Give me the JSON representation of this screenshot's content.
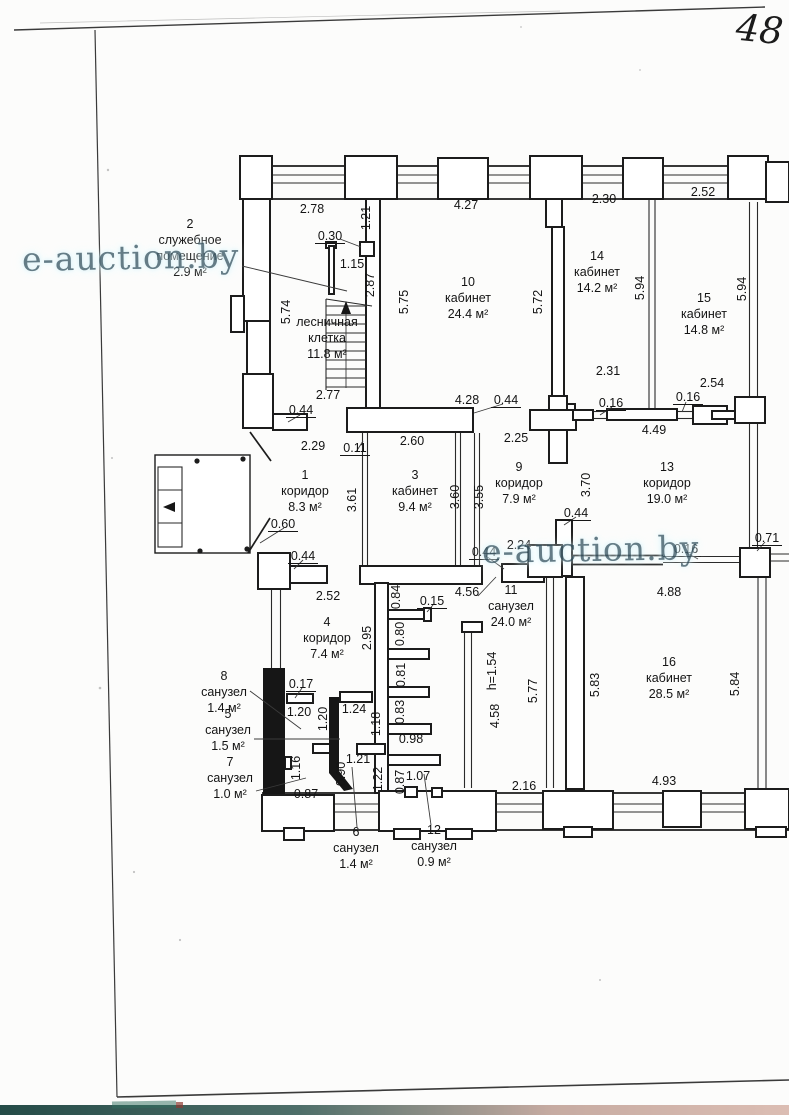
{
  "page": {
    "number_label": "48",
    "watermark_text": "e-auction.by"
  },
  "plan": {
    "rooms": [
      {
        "n": "1",
        "name": [
          "коридор"
        ],
        "area": "8.3 м²",
        "x": 305,
        "y": 475
      },
      {
        "n": "2",
        "name": [
          "служебное",
          "помещение"
        ],
        "area": "2.9 м²",
        "x": 190,
        "y": 224
      },
      {
        "n": "3",
        "name": [
          "кабинет"
        ],
        "area": "9.4 м²",
        "x": 415,
        "y": 475
      },
      {
        "n": "4",
        "name": [
          "коридор"
        ],
        "area": "7.4 м²",
        "x": 327,
        "y": 622
      },
      {
        "n": "5",
        "name": [
          "санузел"
        ],
        "area": "1.5 м²",
        "x": 228,
        "y": 714
      },
      {
        "n": "6",
        "name": [
          "санузел"
        ],
        "area": "1.4 м²",
        "x": 356,
        "y": 832
      },
      {
        "n": "7",
        "name": [
          "санузел"
        ],
        "area": "1.0 м²",
        "x": 230,
        "y": 762
      },
      {
        "n": "8",
        "name": [
          "санузел"
        ],
        "area": "1.4 м²",
        "x": 224,
        "y": 676
      },
      {
        "n": "9",
        "name": [
          "коридор"
        ],
        "area": "7.9 м²",
        "x": 519,
        "y": 467
      },
      {
        "n": "10",
        "name": [
          "кабинет"
        ],
        "area": "24.4 м²",
        "x": 468,
        "y": 282
      },
      {
        "n": "11",
        "name": [
          "санузел"
        ],
        "area": "24.0 м²",
        "x": 511,
        "y": 590
      },
      {
        "n": "12",
        "name": [
          "санузел"
        ],
        "area": "0.9 м²",
        "x": 434,
        "y": 830
      },
      {
        "n": "13",
        "name": [
          "коридор"
        ],
        "area": "19.0 м²",
        "x": 667,
        "y": 467
      },
      {
        "n": "14",
        "name": [
          "кабинет"
        ],
        "area": "14.2 м²",
        "x": 597,
        "y": 256
      },
      {
        "n": "15",
        "name": [
          "кабинет"
        ],
        "area": "14.8 м²",
        "x": 704,
        "y": 298
      },
      {
        "n": "16",
        "name": [
          "кабинет"
        ],
        "area": "28.5 м²",
        "x": 669,
        "y": 662
      },
      {
        "n": "",
        "name": [
          "лесничная",
          "клетка"
        ],
        "area": "11.8 м²",
        "x": 327,
        "y": 322
      }
    ],
    "dimensions": [
      {
        "v": "2.78",
        "x": 312,
        "y": 209
      },
      {
        "v": "1.21",
        "x": 366,
        "y": 218,
        "r": 1
      },
      {
        "v": "4.27",
        "x": 466,
        "y": 205
      },
      {
        "v": "2.30",
        "x": 604,
        "y": 199
      },
      {
        "v": "2.52",
        "x": 703,
        "y": 192
      },
      {
        "v": "0.30",
        "x": 330,
        "y": 236,
        "u": 1
      },
      {
        "v": "1.15",
        "x": 352,
        "y": 264
      },
      {
        "v": "2.87",
        "x": 370,
        "y": 285,
        "r": 1
      },
      {
        "v": "5.74",
        "x": 286,
        "y": 312,
        "r": 1
      },
      {
        "v": "5.75",
        "x": 404,
        "y": 302,
        "r": 1
      },
      {
        "v": "5.72",
        "x": 538,
        "y": 302,
        "r": 1
      },
      {
        "v": "5.94",
        "x": 640,
        "y": 288,
        "r": 1
      },
      {
        "v": "5.94",
        "x": 742,
        "y": 289,
        "r": 1
      },
      {
        "v": "2.31",
        "x": 608,
        "y": 371
      },
      {
        "v": "2.54",
        "x": 712,
        "y": 383
      },
      {
        "v": "0.16",
        "x": 611,
        "y": 403,
        "u": 1
      },
      {
        "v": "0.16",
        "x": 688,
        "y": 397,
        "u": 1
      },
      {
        "v": "4.49",
        "x": 654,
        "y": 430
      },
      {
        "v": "2.77",
        "x": 328,
        "y": 395
      },
      {
        "v": "0.44",
        "x": 301,
        "y": 410,
        "u": 1
      },
      {
        "v": "4.28",
        "x": 467,
        "y": 400
      },
      {
        "v": "0.44",
        "x": 506,
        "y": 400,
        "u": 1
      },
      {
        "v": "2.29",
        "x": 313,
        "y": 446
      },
      {
        "v": "0.11",
        "x": 355,
        "y": 448,
        "u": 1
      },
      {
        "v": "2.60",
        "x": 412,
        "y": 441
      },
      {
        "v": "2.25",
        "x": 516,
        "y": 438
      },
      {
        "v": "3.61",
        "x": 352,
        "y": 500,
        "r": 1
      },
      {
        "v": "3.60",
        "x": 455,
        "y": 497,
        "r": 1
      },
      {
        "v": "3.55",
        "x": 479,
        "y": 497,
        "r": 1
      },
      {
        "v": "3.70",
        "x": 586,
        "y": 485,
        "r": 1
      },
      {
        "v": "0.60",
        "x": 283,
        "y": 524,
        "u": 1
      },
      {
        "v": "0.44",
        "x": 303,
        "y": 556,
        "u": 1
      },
      {
        "v": "2.24",
        "x": 519,
        "y": 545
      },
      {
        "v": "0.44",
        "x": 484,
        "y": 552,
        "u": 1
      },
      {
        "v": "0.44",
        "x": 576,
        "y": 513,
        "u": 1
      },
      {
        "v": "0.16",
        "x": 686,
        "y": 549,
        "u": 1
      },
      {
        "v": "0.71",
        "x": 767,
        "y": 538,
        "u": 1
      },
      {
        "v": "2.52",
        "x": 328,
        "y": 596
      },
      {
        "v": "0.84",
        "x": 396,
        "y": 597,
        "r": 1
      },
      {
        "v": "0.15",
        "x": 432,
        "y": 601,
        "u": 1
      },
      {
        "v": "4.56",
        "x": 467,
        "y": 592
      },
      {
        "v": "2.95",
        "x": 367,
        "y": 638,
        "r": 1
      },
      {
        "v": "0.80",
        "x": 400,
        "y": 634,
        "r": 1
      },
      {
        "v": "0.81",
        "x": 401,
        "y": 675,
        "r": 1
      },
      {
        "v": "0.83",
        "x": 400,
        "y": 712,
        "r": 1
      },
      {
        "v": "0.98",
        "x": 411,
        "y": 739
      },
      {
        "v": "h=1.54",
        "x": 492,
        "y": 671,
        "r": 1
      },
      {
        "v": "4.58",
        "x": 495,
        "y": 716,
        "r": 1
      },
      {
        "v": "5.77",
        "x": 533,
        "y": 691,
        "r": 1
      },
      {
        "v": "5.83",
        "x": 595,
        "y": 685,
        "r": 1
      },
      {
        "v": "4.88",
        "x": 669,
        "y": 592
      },
      {
        "v": "5.84",
        "x": 735,
        "y": 684,
        "r": 1
      },
      {
        "v": "0.17",
        "x": 301,
        "y": 684,
        "u": 1
      },
      {
        "v": "1.20",
        "x": 299,
        "y": 712
      },
      {
        "v": "1.20",
        "x": 323,
        "y": 719,
        "r": 1
      },
      {
        "v": "1.24",
        "x": 354,
        "y": 709
      },
      {
        "v": "1.18",
        "x": 376,
        "y": 724,
        "r": 1
      },
      {
        "v": "1.16",
        "x": 296,
        "y": 768,
        "r": 1
      },
      {
        "v": "1.21",
        "x": 358,
        "y": 759
      },
      {
        "v": "0.90",
        "x": 341,
        "y": 774,
        "r": 1
      },
      {
        "v": "1.22",
        "x": 378,
        "y": 779,
        "r": 1
      },
      {
        "v": "0.87",
        "x": 306,
        "y": 794
      },
      {
        "v": "0.87",
        "x": 400,
        "y": 782,
        "r": 1
      },
      {
        "v": "1.07",
        "x": 418,
        "y": 776
      },
      {
        "v": "2.16",
        "x": 524,
        "y": 786
      },
      {
        "v": "4.93",
        "x": 664,
        "y": 781
      }
    ]
  }
}
